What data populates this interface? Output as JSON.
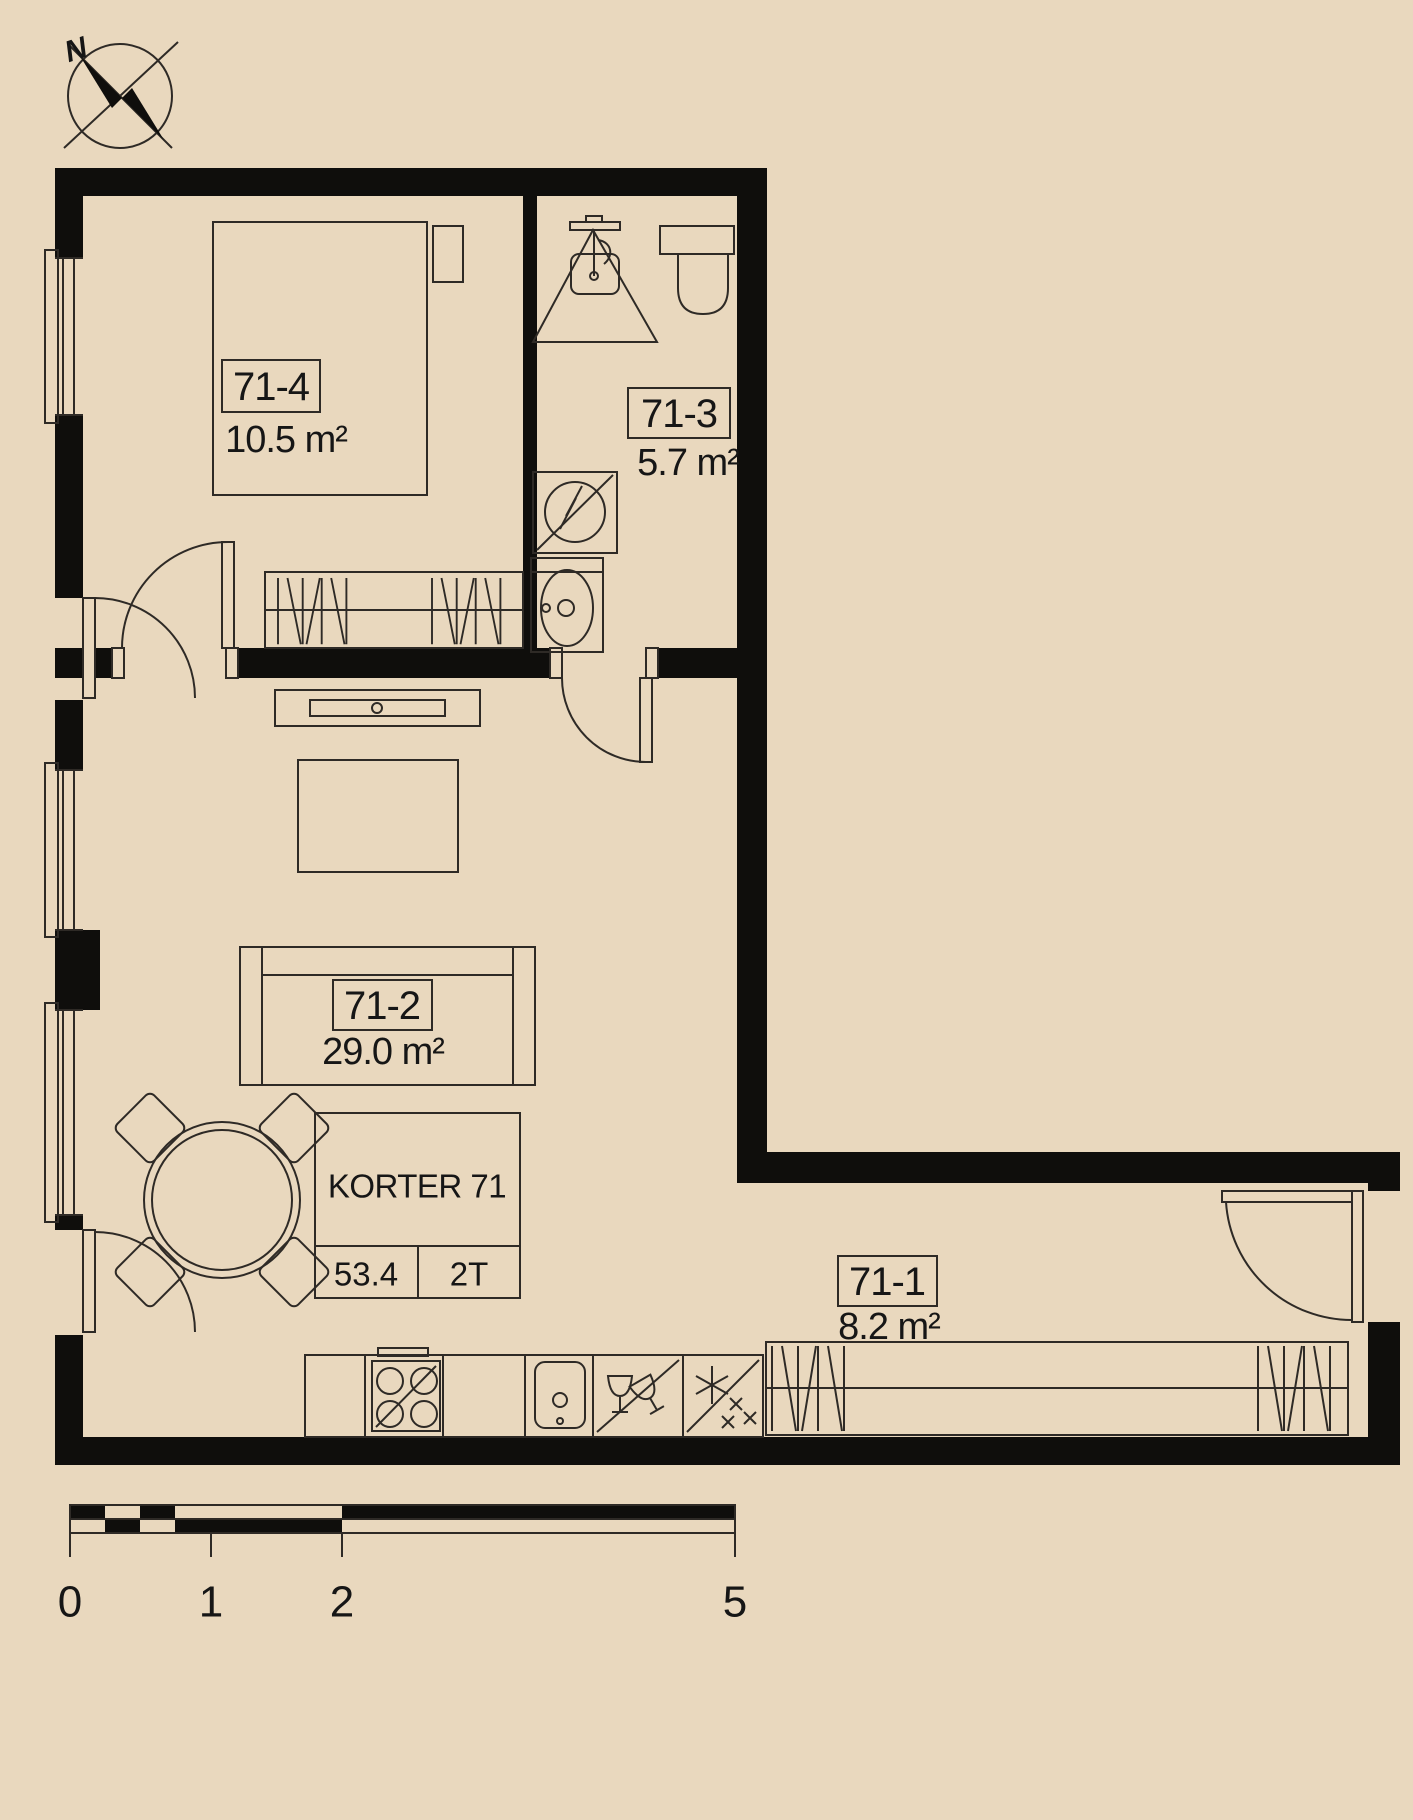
{
  "palette": {
    "background": "#e9d8be",
    "wall": "#0f0e0c",
    "line": "#2e2a26",
    "text": "#161616"
  },
  "compass": {
    "north_label": "N"
  },
  "unit_table": {
    "title": "KORTER 71",
    "total_area": "53.4",
    "room_count": "2T"
  },
  "rooms": [
    {
      "id": "71-1",
      "area": "8.2 m²",
      "type": "hall"
    },
    {
      "id": "71-2",
      "area": "29.0 m²",
      "type": "living-kitchen"
    },
    {
      "id": "71-3",
      "area": "5.7 m²",
      "type": "bathroom"
    },
    {
      "id": "71-4",
      "area": "10.5 m²",
      "type": "bedroom"
    }
  ],
  "scale_bar": {
    "tick_labels": [
      "0",
      "1",
      "2",
      "5"
    ]
  }
}
